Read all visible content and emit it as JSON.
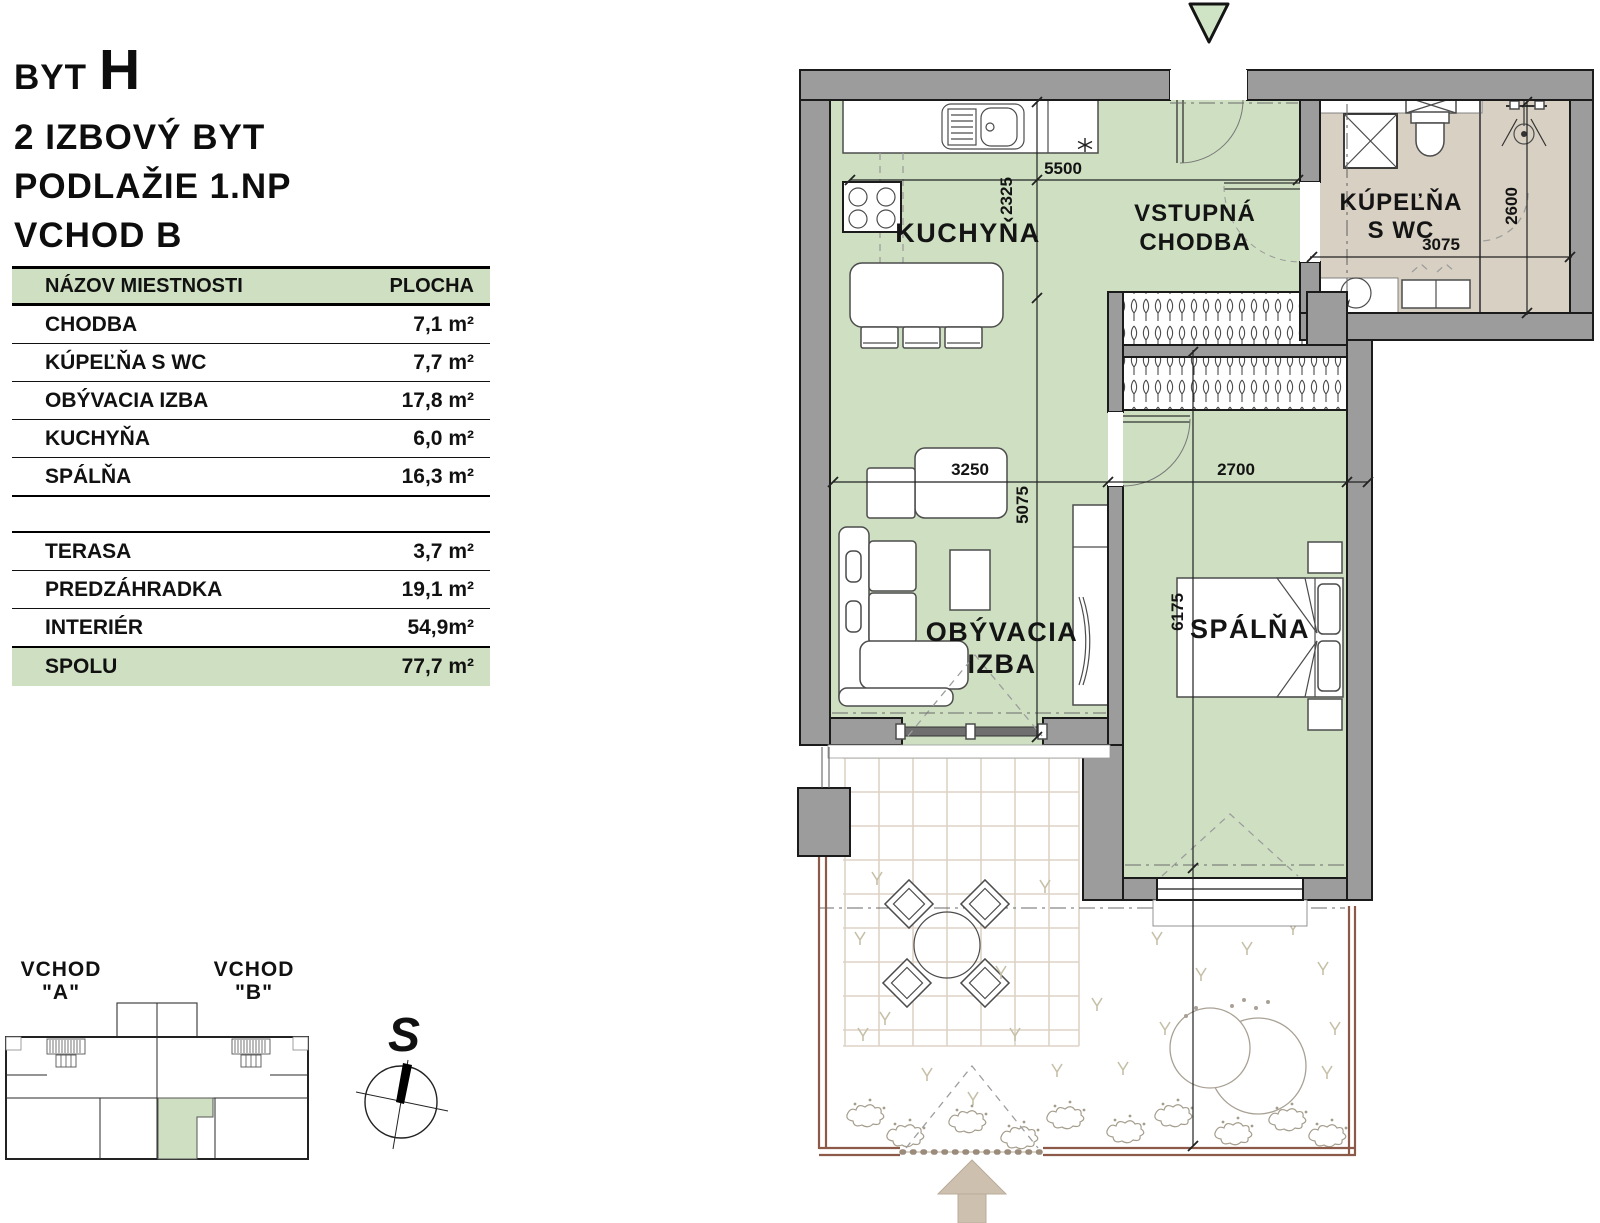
{
  "title": {
    "apartment_label": "BYT",
    "apartment_letter": "H",
    "type": "2 IZBOVÝ BYT",
    "floor": "PODLAŽIE 1.NP",
    "entrance": "VCHOD B"
  },
  "area_table": {
    "header": {
      "name": "NÁZOV MIESTNOSTI",
      "area": "PLOCHA"
    },
    "rooms": [
      {
        "name": "CHODBA",
        "area": "7,1 m²"
      },
      {
        "name": "KÚPEĽŇA S WC",
        "area": "7,7 m²"
      },
      {
        "name": "OBÝVACIA IZBA",
        "area": "17,8 m²"
      },
      {
        "name": "KUCHYŇA",
        "area": "6,0 m²"
      },
      {
        "name": "SPÁLŇA",
        "area": "16,3 m²"
      }
    ],
    "exterior": [
      {
        "name": "TERASA",
        "area": "3,7 m²"
      },
      {
        "name": "PREDZÁHRADKA",
        "area": "19,1 m²"
      },
      {
        "name": "INTERIÉR",
        "area": "54,9m²"
      }
    ],
    "total": {
      "name": "SPOLU",
      "area": "77,7 m²"
    }
  },
  "site_plan": {
    "entrance_a_line1": "VCHOD",
    "entrance_a_line2": "\"A\"",
    "entrance_b_line1": "VCHOD",
    "entrance_b_line2": "\"B\"",
    "compass_letter": "S"
  },
  "floor_plan": {
    "rooms": {
      "kitchen": "KUCHYŇA",
      "hall_line1": "VSTUPNÁ",
      "hall_line2": "CHODBA",
      "living_line1": "OBÝVACIA",
      "living_line2": "IZBA",
      "bedroom": "SPÁLŇA",
      "bath_line1": "KÚPEĽŇA",
      "bath_line2": "S WC"
    },
    "dimensions": {
      "kitchen_width": "5500",
      "kitchen_depth": "2325",
      "living_height": "5075",
      "living_width": "3250",
      "bedroom_width": "2700",
      "bedroom_depth": "6175",
      "bath_width": "3075",
      "bath_depth": "2600"
    },
    "colors": {
      "room_green": "#cfe0c2",
      "bath_tan": "#d8d1c3",
      "wall_gray": "#9c9c9c",
      "table_accent_green": "#cfe0c2",
      "fence_brown": "#8d5a49",
      "arrow_tan": "#cdc0af",
      "entrance_triangle_green": "#cfe3c5"
    }
  }
}
